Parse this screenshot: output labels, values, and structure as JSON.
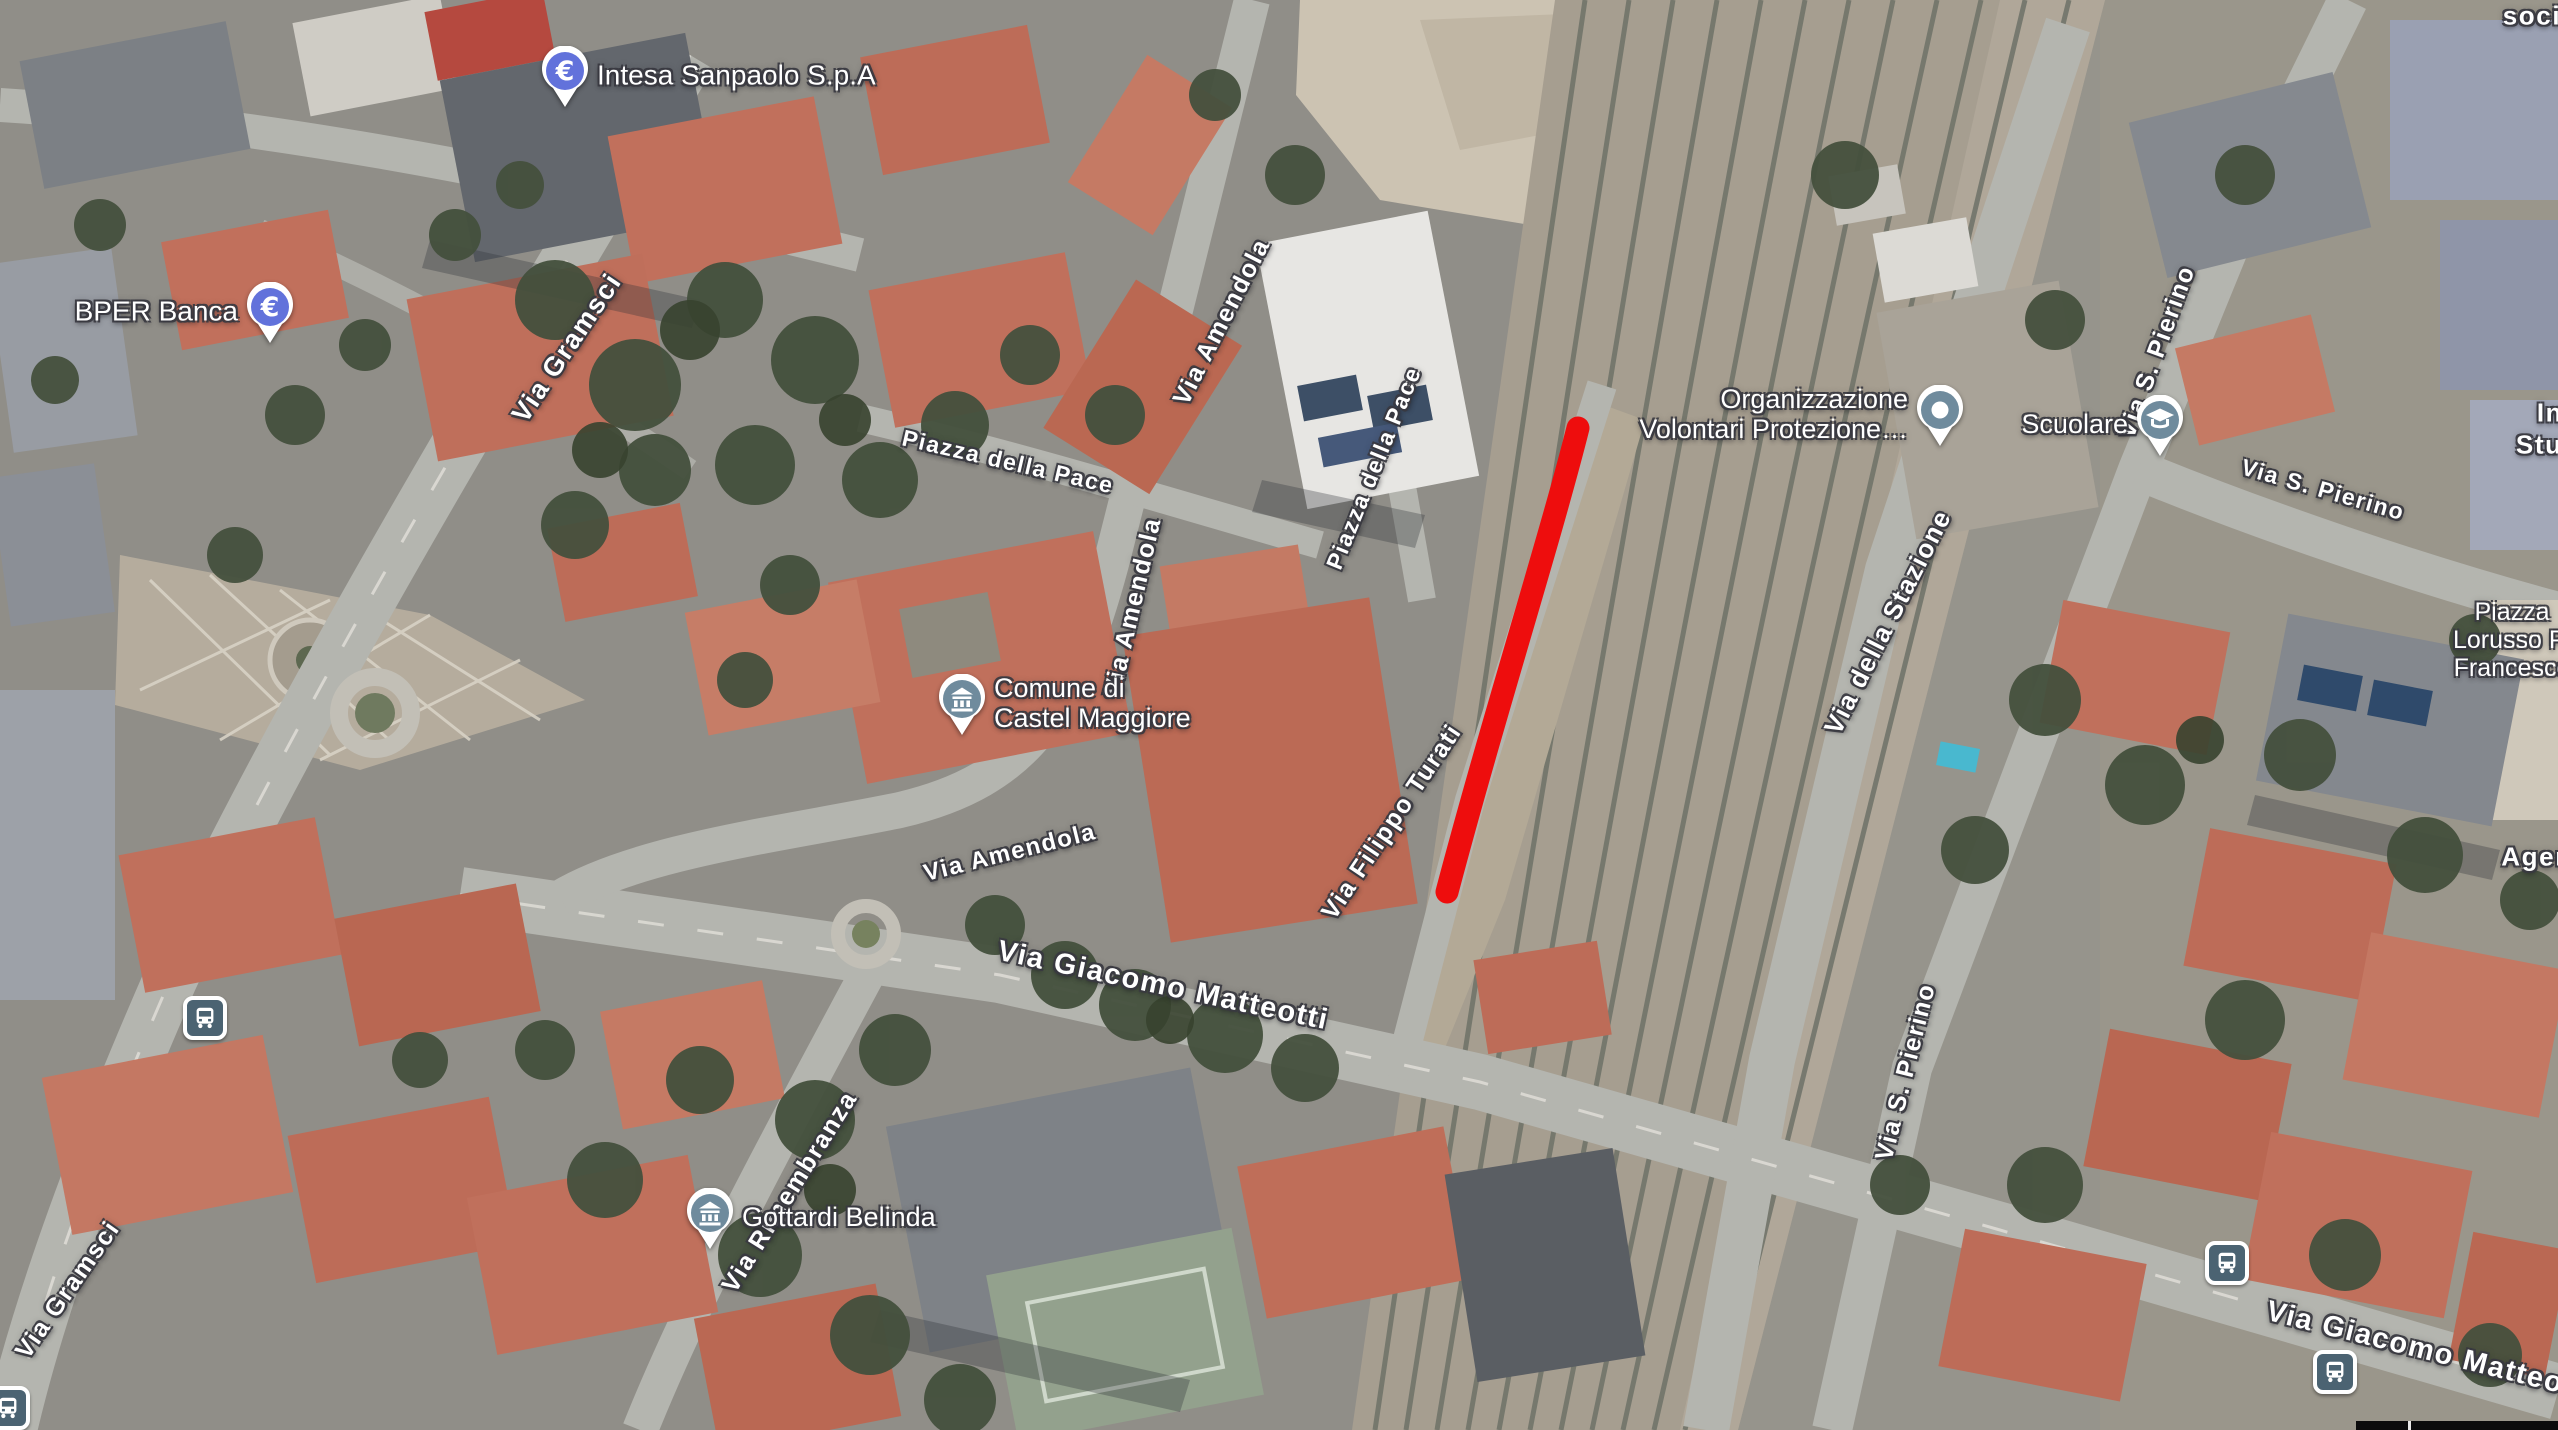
{
  "map": {
    "view_type": "satellite",
    "annotation": {
      "description": "red route highlight along Via Filippo Turati beside railway",
      "color": "#ee0d0d",
      "stroke_width": 23,
      "path_d": "M 1578 428 C 1549 543 1493 718 1447 892"
    },
    "street_labels": [
      {
        "id": "via-gramsci-north",
        "text": "Via Gramsci",
        "x": 567,
        "y": 348,
        "rotate": -56,
        "size": 27
      },
      {
        "id": "via-gramsci-south",
        "text": "Via Gramsci",
        "x": 68,
        "y": 1290,
        "rotate": -55,
        "size": 25
      },
      {
        "id": "piazza-della-pace-west",
        "text": "Piazza della Pace",
        "x": 1008,
        "y": 462,
        "rotate": 13,
        "size": 23
      },
      {
        "id": "via-amendola-north",
        "text": "Via Amendola",
        "x": 1222,
        "y": 322,
        "rotate": -63,
        "size": 25
      },
      {
        "id": "piazza-della-pace-east",
        "text": "Piazza della Pace",
        "x": 1374,
        "y": 468,
        "rotate": -68,
        "size": 23
      },
      {
        "id": "via-amendola-mid",
        "text": "Via Amendola",
        "x": 1133,
        "y": 607,
        "rotate": -77,
        "size": 25
      },
      {
        "id": "via-amendola-south",
        "text": "Via Amendola",
        "x": 1010,
        "y": 853,
        "rotate": -14,
        "size": 24
      },
      {
        "id": "via-giacomo-matteotti",
        "text": "Via Giacomo Matteotti",
        "x": 1163,
        "y": 986,
        "rotate": 12,
        "size": 29
      },
      {
        "id": "via-filippo-turati",
        "text": "Via Filippo Turati",
        "x": 1392,
        "y": 822,
        "rotate": -56,
        "size": 25
      },
      {
        "id": "via-della-stazione",
        "text": "Via della Stazione",
        "x": 1888,
        "y": 622,
        "rotate": -63,
        "size": 26
      },
      {
        "id": "via-s-pierino-north",
        "text": "Via S. Pierino",
        "x": 2157,
        "y": 352,
        "rotate": -70,
        "size": 25
      },
      {
        "id": "via-s-pierino-east",
        "text": "Via S. Pierino",
        "x": 2323,
        "y": 490,
        "rotate": 16,
        "size": 23
      },
      {
        "id": "via-s-pierino-south",
        "text": "Via S. Pierino",
        "x": 1906,
        "y": 1072,
        "rotate": -76,
        "size": 25
      },
      {
        "id": "via-rimembranza",
        "text": "Via Rimembranza",
        "x": 790,
        "y": 1192,
        "rotate": -58,
        "size": 25
      },
      {
        "id": "via-giacomo-matteo-se",
        "text": "Via Giacomo Matteo",
        "x": 2415,
        "y": 1348,
        "rotate": 14,
        "size": 29
      }
    ],
    "edge_labels": [
      {
        "id": "fragment-socia",
        "text": "socia",
        "x": 2540,
        "y": 16,
        "size": 26
      },
      {
        "id": "fragment-in",
        "text": "In",
        "x": 2550,
        "y": 413,
        "size": 26
      },
      {
        "id": "fragment-stud",
        "text": "Stud",
        "x": 2548,
        "y": 445,
        "size": 26
      },
      {
        "id": "fragment-agen",
        "text": "Agen",
        "x": 2537,
        "y": 857,
        "size": 26
      }
    ],
    "pois": [
      {
        "id": "intesa-sanpaolo",
        "lines": [
          "Intesa Sanpaolo S.p.A"
        ],
        "icon": "euro-pin",
        "icon_color": "#6272db",
        "x": 565,
        "y": 75,
        "text_side": "right",
        "size": 28
      },
      {
        "id": "bper-banca",
        "lines": [
          "BPER Banca"
        ],
        "icon": "euro-pin",
        "icon_color": "#6272db",
        "x": 270,
        "y": 311,
        "text_side": "left",
        "size": 28
      },
      {
        "id": "comune-castel-maggiore",
        "lines": [
          "Comune di",
          "Castel Maggiore"
        ],
        "icon": "government-pin",
        "icon_color": "#6f8b9d",
        "x": 962,
        "y": 703,
        "text_side": "right",
        "size": 27
      },
      {
        "id": "organizzazione-volontari",
        "lines": [
          "Organizzazione",
          "Volontari Protezione…"
        ],
        "icon": "place-pin",
        "icon_color": "#6f8b9d",
        "x": 1940,
        "y": 414,
        "text_side": "left",
        "size": 27
      },
      {
        "id": "scuolare",
        "lines": [
          "Scuolare"
        ],
        "icon": "school-pin",
        "icon_color": "#6f8b9d",
        "x": 2160,
        "y": 424,
        "text_side": "left",
        "size": 27
      },
      {
        "id": "gottardi-belinda",
        "lines": [
          "Gottardi Belinda"
        ],
        "icon": "government-pin",
        "icon_color": "#6f8b9d",
        "x": 710,
        "y": 1217,
        "text_side": "right",
        "size": 27
      },
      {
        "id": "piazza-lorusso-francesco",
        "lines": [
          "Piazza",
          "Lorusso Pi",
          "Francesco"
        ],
        "icon": null,
        "icon_color": null,
        "x": 2512,
        "y": 640,
        "text_side": "center",
        "size": 25
      }
    ],
    "transit_stops": [
      {
        "id": "bus-stop-gramsci",
        "x": 205,
        "y": 1018
      },
      {
        "id": "bus-stop-matteotti-north",
        "x": 2227,
        "y": 1263
      },
      {
        "id": "bus-stop-matteotti-south",
        "x": 2335,
        "y": 1372
      },
      {
        "id": "bus-stop-corner",
        "x": 8,
        "y": 1408
      }
    ],
    "transit_icon_color": "#4b6372"
  }
}
